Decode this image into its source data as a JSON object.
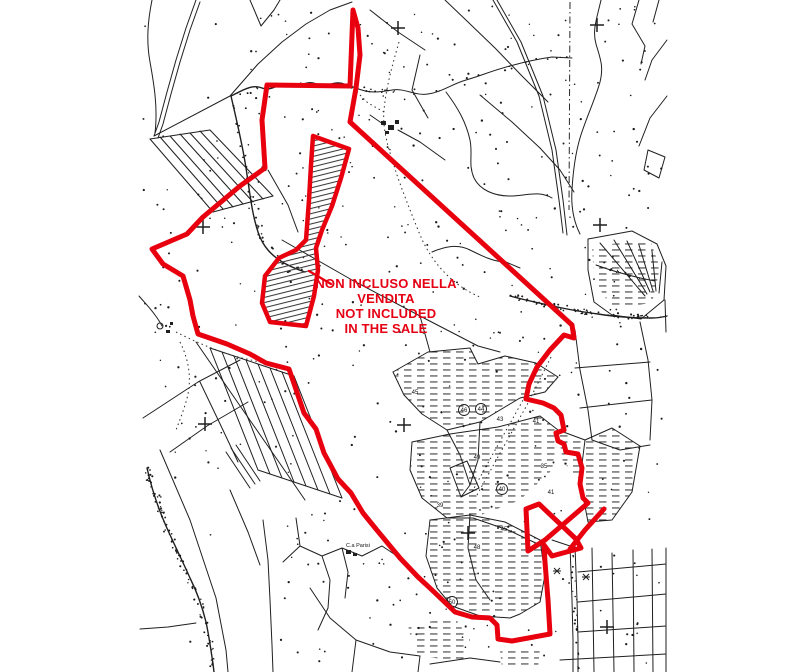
{
  "map": {
    "type": "cadastral-plan",
    "annotation": {
      "color": "#e60013",
      "lines": [
        "NON INCLUSO NELLA",
        "VENDITA",
        "NOT INCLUDED",
        "IN THE SALE"
      ]
    },
    "boundary_color": "#e8000f",
    "labels": {
      "farm": "C.a Parisi"
    },
    "parcel_numbers": [
      {
        "label": "45",
        "x": 415,
        "y": 394,
        "circled": false
      },
      {
        "label": "46",
        "x": 464,
        "y": 412,
        "circled": true
      },
      {
        "label": "44",
        "x": 481,
        "y": 411,
        "circled": true
      },
      {
        "label": "43",
        "x": 500,
        "y": 421,
        "circled": false
      },
      {
        "label": "41",
        "x": 536,
        "y": 423,
        "circled": false
      },
      {
        "label": "49",
        "x": 477,
        "y": 459,
        "circled": false
      },
      {
        "label": "35",
        "x": 544,
        "y": 468,
        "circled": false
      },
      {
        "label": "40",
        "x": 502,
        "y": 491,
        "circled": true
      },
      {
        "label": "41",
        "x": 551,
        "y": 494,
        "circled": false
      },
      {
        "label": "39",
        "x": 440,
        "y": 507,
        "circled": false
      },
      {
        "label": "45",
        "x": 504,
        "y": 531,
        "circled": false
      },
      {
        "label": "48",
        "x": 477,
        "y": 549,
        "circled": false
      },
      {
        "label": "50",
        "x": 452,
        "y": 604,
        "circled": true
      }
    ]
  }
}
